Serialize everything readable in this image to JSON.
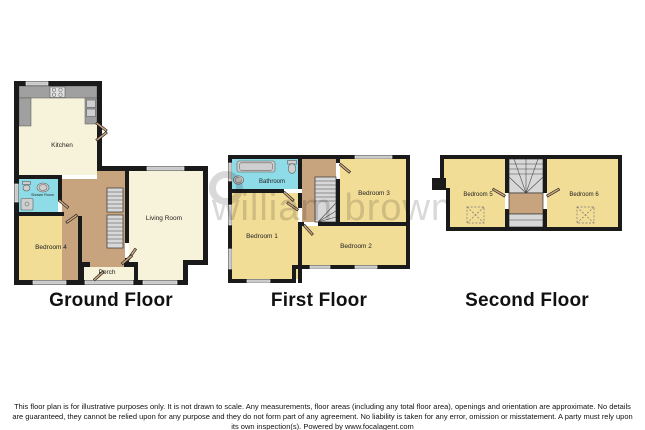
{
  "watermark": {
    "text": "william brown"
  },
  "ground": {
    "title": "Ground Floor",
    "rooms": {
      "kitchen": "Kitchen",
      "shower_room": "Shower Room",
      "bedroom4": "Bedroom 4",
      "living_room": "Living Room",
      "porch": "Porch"
    }
  },
  "first": {
    "title": "First Floor",
    "rooms": {
      "bathroom": "Bathroom",
      "bedroom1": "Bedroom 1",
      "bedroom2": "Bedroom 2",
      "bedroom3": "Bedroom 3"
    }
  },
  "second": {
    "title": "Second Floor",
    "rooms": {
      "bedroom5": "Bedroom 5",
      "bedroom6": "Bedroom 6"
    }
  },
  "disclaimer": "This floor plan is for illustrative purposes only. It is not drawn to scale. Any measurements, floor areas (including any total floor area), openings and orientation are approximate. No details are guaranteed, they cannot be relied upon for any purpose and they do not form part of any agreement. No liability is taken for any error, omission or misstatement. A party must rely upon its own inspection(s). Powered by www.focalagent.com",
  "colors": {
    "wall": "#1a1a1a",
    "floor_cream": "#f7f3da",
    "floor_yellow": "#f2dd96",
    "floor_tan": "#c8a47e",
    "floor_blue": "#8edce8",
    "stair_gray": "#d8d8d8",
    "counter_gray": "#a0a0a0",
    "window_gray": "#c8c8c8",
    "fixture_gray": "#cfcfcf",
    "label": "#222222",
    "watermark": "#d9d9d9"
  }
}
